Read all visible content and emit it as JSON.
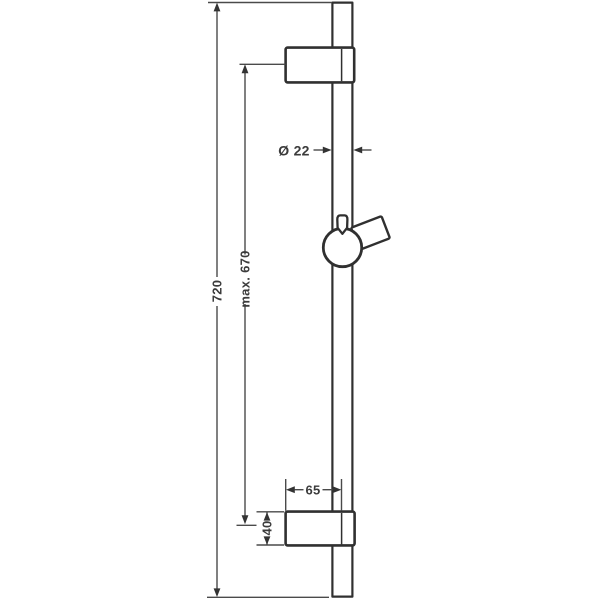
{
  "drawing": {
    "kind": "technical-dimension-drawing",
    "subject": "shower-rail-with-slider-and-wall-brackets"
  },
  "dimensions": {
    "overall_height_label": "720",
    "max_mounting_distance_label": "max. 670",
    "rail_diameter_label": "Ø 22",
    "wall_offset_label": "65",
    "bracket_height_label": "40"
  },
  "colors": {
    "background": "#ffffff",
    "object_line": "#303030",
    "dimension_line": "#4a4a4a",
    "arrow_fill": "#333333",
    "text": "#3b3b3b"
  }
}
